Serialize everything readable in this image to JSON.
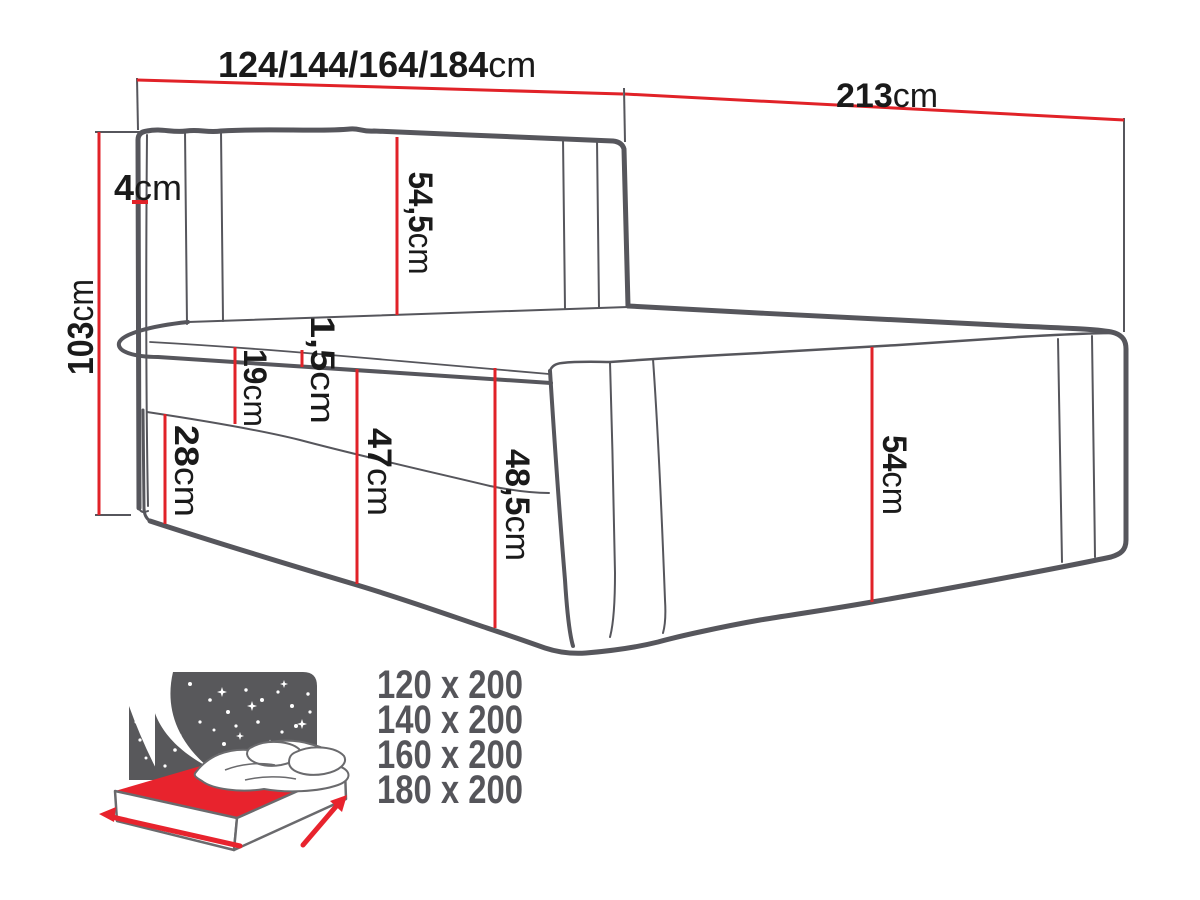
{
  "diagram": {
    "title": "bed-dimensions-technical-drawing",
    "dims": {
      "width": {
        "num": "124/144/164/184",
        "unit": "cm"
      },
      "length": {
        "num": "213",
        "unit": "cm"
      },
      "height": {
        "num": "103",
        "unit": "cm"
      },
      "headboard_thickness": {
        "num": "4",
        "unit": "cm"
      },
      "headboard_panel": {
        "num": "54,5",
        "unit": "cm"
      },
      "topper": {
        "num": "1,5",
        "unit": "cm"
      },
      "mattress": {
        "num": "19",
        "unit": "cm"
      },
      "base": {
        "num": "28",
        "unit": "cm"
      },
      "front_height": {
        "num": "47",
        "unit": "cm"
      },
      "foot_height": {
        "num": "48,5",
        "unit": "cm"
      },
      "side_height": {
        "num": "54",
        "unit": "cm"
      }
    },
    "sizes": [
      "120 x 200",
      "140 x 200",
      "160 x 200",
      "180 x 200"
    ],
    "colors": {
      "dimension_red": "#e12228",
      "line_gray": "#56565c",
      "icon_gray": "#58585b",
      "icon_red": "#e8232d",
      "text_dark": "#1a1a1a",
      "sizes_gray": "#55555a"
    }
  }
}
